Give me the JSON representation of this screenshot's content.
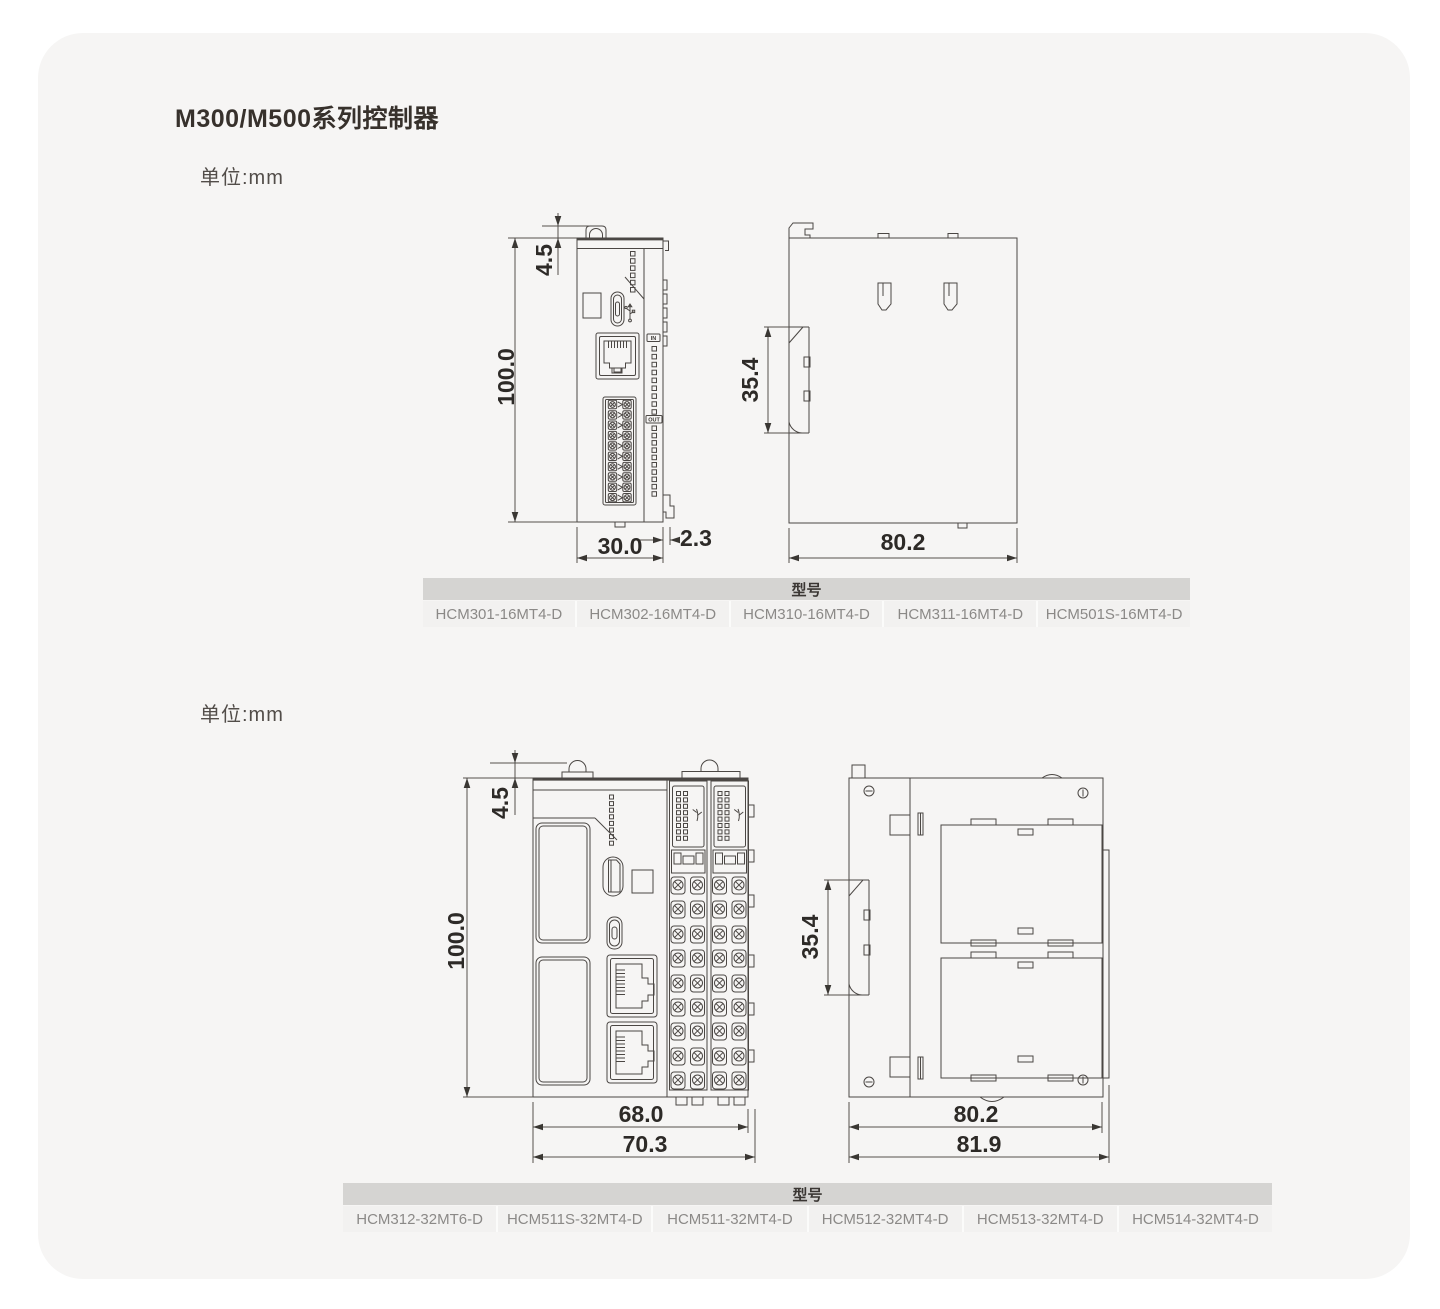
{
  "page": {
    "title": "M300/M500系列控制器"
  },
  "sections": [
    {
      "unit_label": "单位:mm",
      "front_view": {
        "dims": {
          "tab_offset": "4.5",
          "height": "100.0",
          "width": "30.0",
          "lip": "2.3"
        },
        "labels": {
          "in": "IN",
          "out": "OUT"
        }
      },
      "side_view": {
        "dims": {
          "din_rail": "35.4",
          "depth": "80.2"
        }
      },
      "table": {
        "header": "型号",
        "models": [
          "HCM301-16MT4-D",
          "HCM302-16MT4-D",
          "HCM310-16MT4-D",
          "HCM311-16MT4-D",
          "HCM501S-16MT4-D"
        ]
      }
    },
    {
      "unit_label": "单位:mm",
      "front_view": {
        "dims": {
          "tab_offset": "4.5",
          "height": "100.0",
          "width": "68.0",
          "total_width": "70.3"
        }
      },
      "side_view": {
        "dims": {
          "din_rail": "35.4",
          "depth": "80.2",
          "total_depth": "81.9"
        }
      },
      "table": {
        "header": "型号",
        "models": [
          "HCM312-32MT6-D",
          "HCM511S-32MT4-D",
          "HCM511-32MT4-D",
          "HCM512-32MT4-D",
          "HCM513-32MT4-D",
          "HCM514-32MT4-D"
        ]
      }
    }
  ],
  "colors": {
    "card_bg": "#f6f5f4",
    "drawing_line": "#4b4744",
    "dimension_text": "#2d2a27",
    "table_header_bg": "#d5d4d2",
    "table_cell_bg": "#f2f1f0",
    "table_cell_text": "#8b8987"
  }
}
